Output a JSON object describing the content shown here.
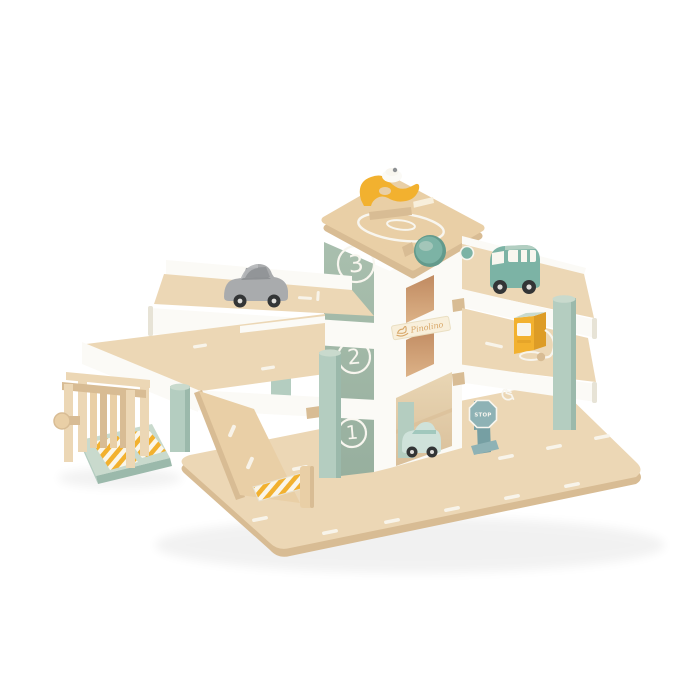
{
  "page": {
    "background": "#ffffff"
  },
  "palette": {
    "bg": "#ffffff",
    "wood": "#ecd7b5",
    "wood2": "#e9cfa6",
    "woodDark": "#d8bc94",
    "white": "#fbfaf6",
    "whiteShade": "#e7e3d6",
    "sage": "#a9bfae",
    "sageDark": "#97af9e",
    "mint": "#b4cdc0",
    "mintDark": "#9bb9ab",
    "mintLight": "#c9dacd",
    "yellow": "#f2b12f",
    "yellowDark": "#dd9c26",
    "teal": "#7cb3a5",
    "tealDark": "#639a8c",
    "grayCar": "#a9abad",
    "grayDark": "#8e9194",
    "steel": "#8eb2b5",
    "steelDark": "#769fa3",
    "cream": "#f8efdb",
    "gold": "#d7a565",
    "interior": "#c08a61",
    "interior2": "#dcb287",
    "line": "#f8f6ef",
    "carMint": "#cfe2da",
    "wheel": "#333536",
    "hub": "#dfdedb"
  },
  "toy": {
    "brand_label": "Pinolino",
    "floor_numbers": [
      "3",
      "2",
      "1"
    ],
    "stop_sign_label": "STOP",
    "objects": [
      "wooden parking garage",
      "helipad roof",
      "yellow helicopter",
      "elevator tower",
      "elevator crank knob",
      "silver car",
      "teal van",
      "mint car",
      "petrol pump",
      "stop sign",
      "car wash",
      "exit ramp",
      "striped crash barrier",
      "road base plate",
      "disabled parking marking"
    ]
  }
}
